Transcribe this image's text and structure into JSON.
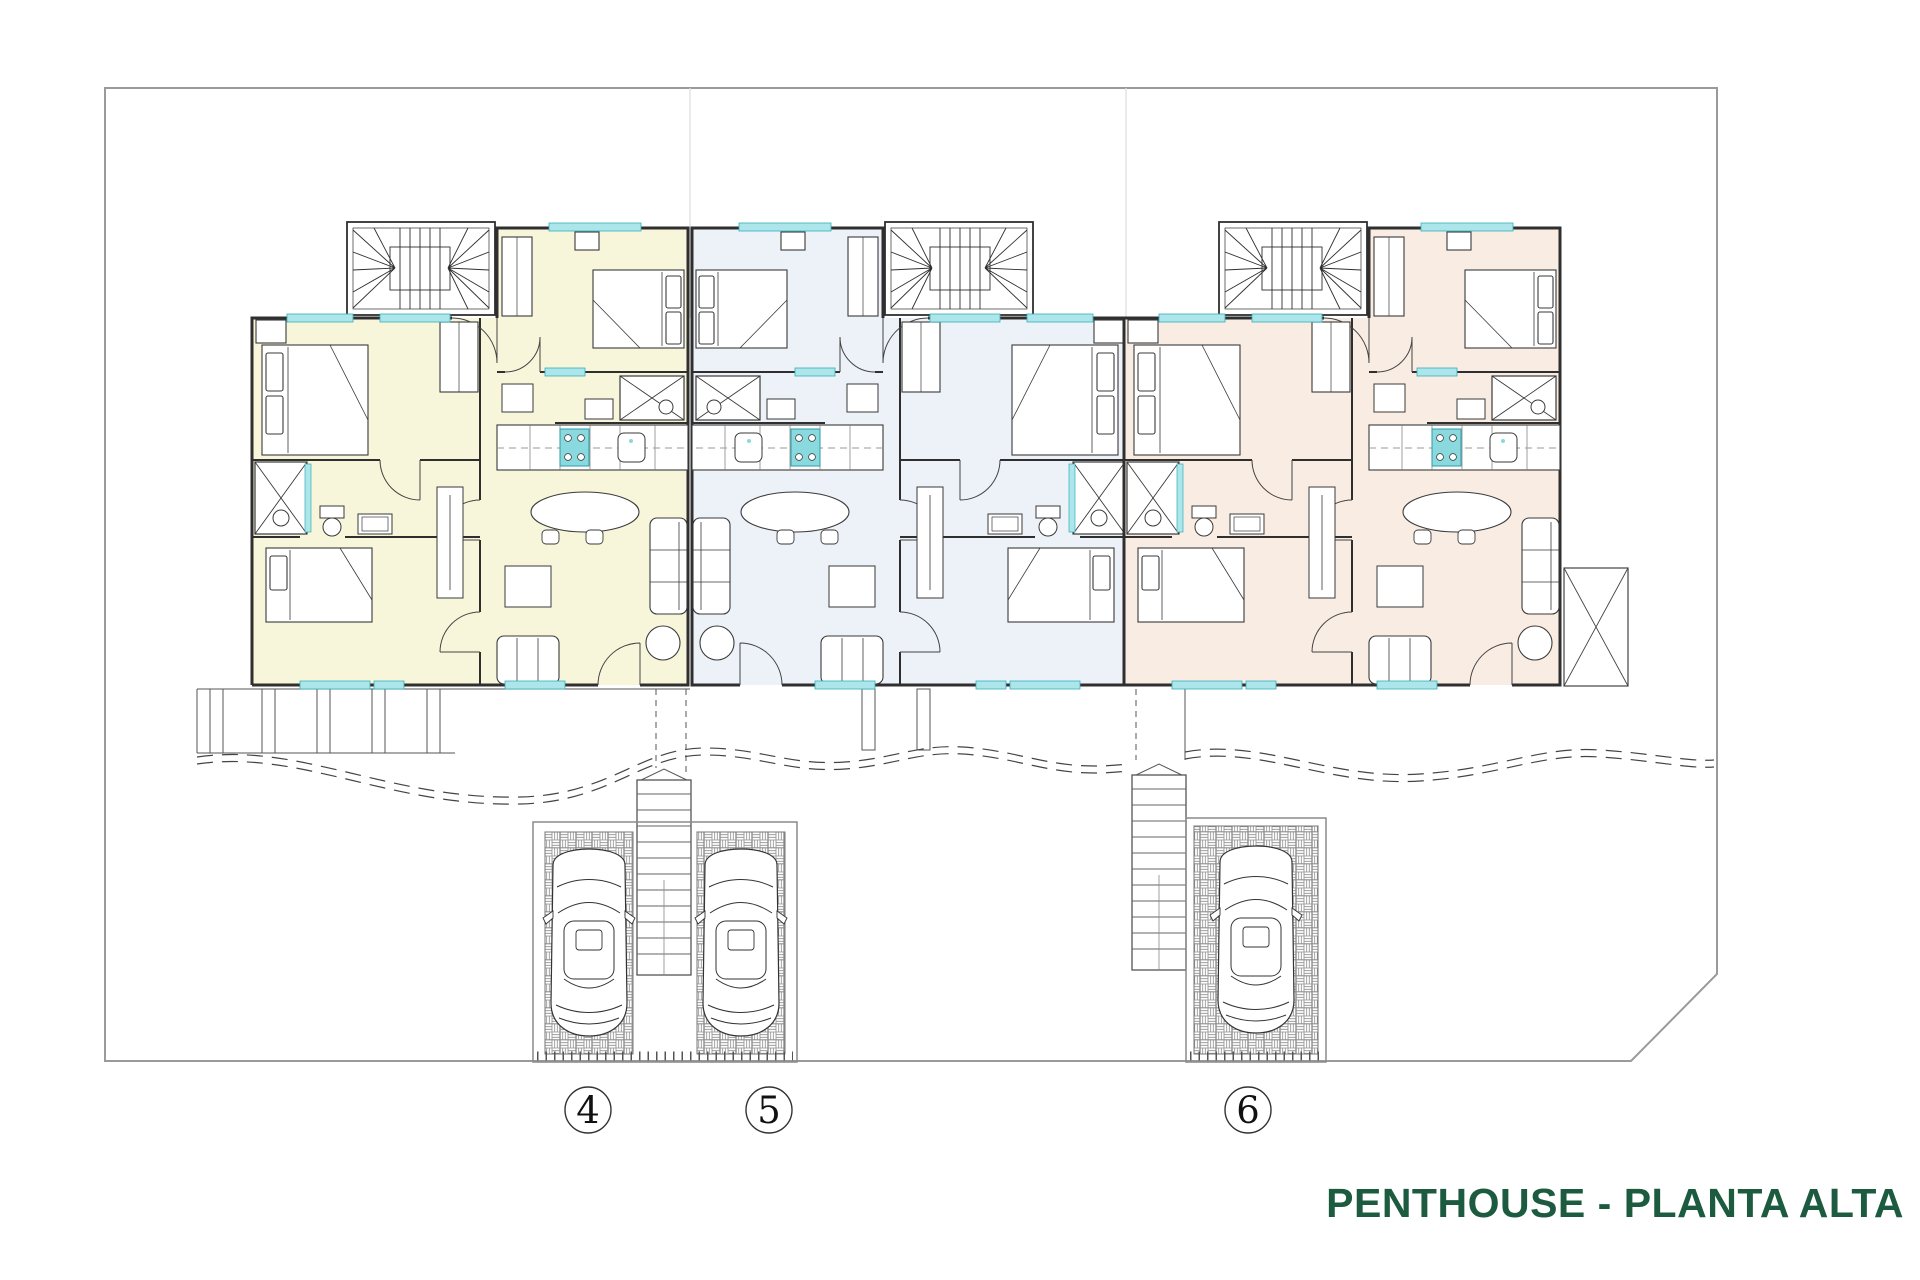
{
  "title": {
    "text": "PENTHOUSE - PLANTA ALTA"
  },
  "units": [
    {
      "number": "4",
      "tint": "#f8f6da"
    },
    {
      "number": "5",
      "tint": "#ecf2f7"
    },
    {
      "number": "6",
      "tint": "#f9ece3"
    }
  ],
  "palette": {
    "background": "#ffffff",
    "plot_line": "#9a9a9a",
    "wall_line": "#2f2f2f",
    "window_glass": "#ace6ea",
    "fixture_teal": "#8ad9de",
    "title_green": "#1d5b40"
  }
}
